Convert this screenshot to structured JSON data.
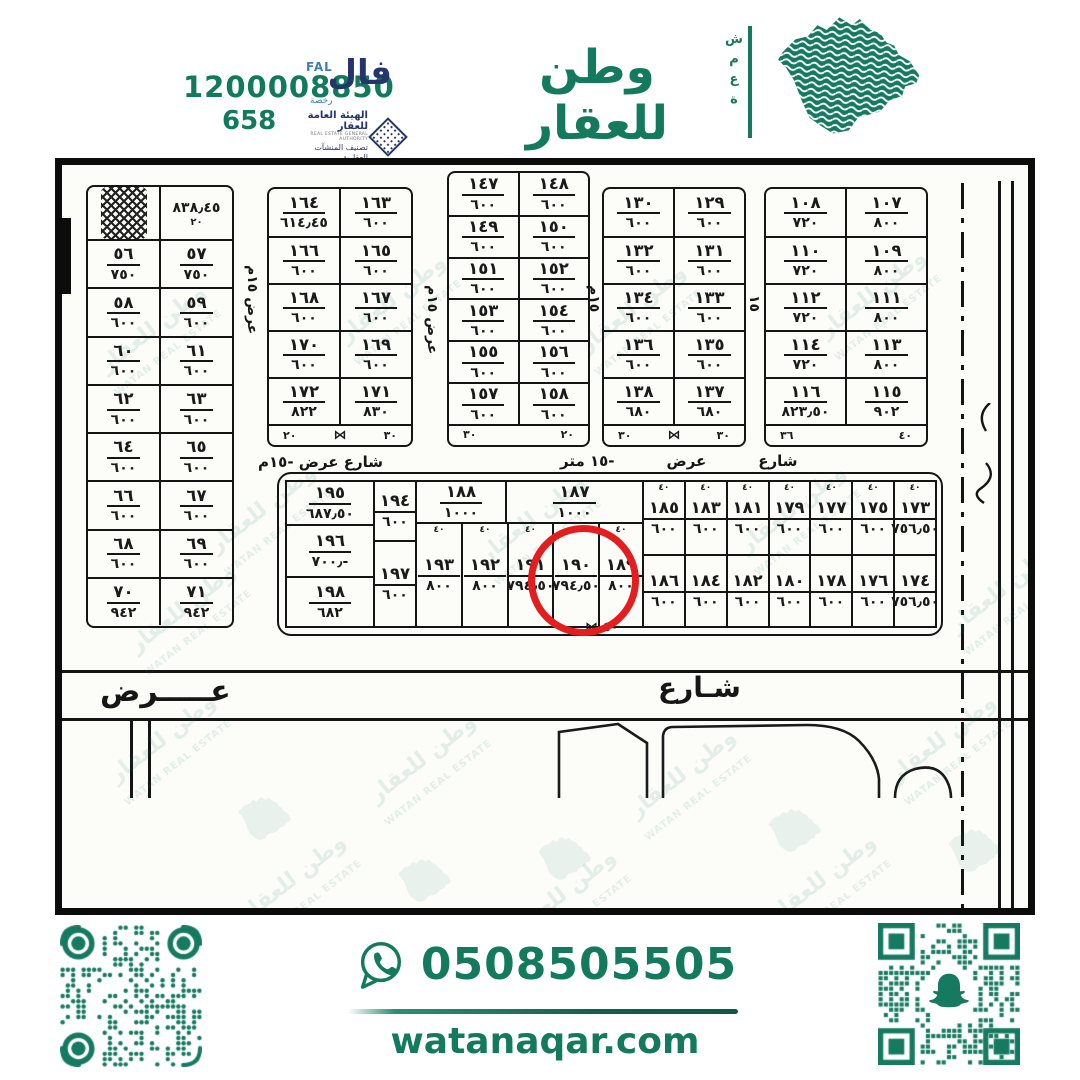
{
  "colors": {
    "brand": "#147a5e",
    "navy": "#25346b",
    "red": "#e41e1e",
    "ink": "#151515"
  },
  "header": {
    "phone_main": "1200008850",
    "phone_small": "658",
    "fal": {
      "arabic": "فال",
      "latin": "FAL",
      "license": "رخصة",
      "authority_ar": "الهيئة العامة للعقار",
      "authority_en": "REAL ESTATE GENERAL AUTHORITY",
      "classification": "تصنيف المنشآت العقارية"
    },
    "brand": {
      "arabic": "وطن للعقار",
      "english": "WATAN REAL ESTATE",
      "vertical_word": "شمعة"
    }
  },
  "map": {
    "watermark": {
      "text_ar": "وطن للعقار",
      "text_en": "WATAN REAL ESTATE"
    },
    "dims": {
      "d20": "٢٠",
      "d26": "٢٦",
      "d30": "٣٠",
      "d36": "٣٦",
      "d40": "٤٠",
      "bow": "⋈"
    },
    "special_cell": {
      "value": "٨٣٨٫٤٥",
      "sub": "٢٠"
    },
    "blocks": {
      "blockA": [
        [
          [
            "٥٦",
            "٧٥٠"
          ],
          [
            "٥٧",
            "٧٥٠"
          ]
        ],
        [
          [
            "٥٨",
            "٦٠٠"
          ],
          [
            "٥٩",
            "٦٠٠"
          ]
        ],
        [
          [
            "٦٠",
            "٦٠٠"
          ],
          [
            "٦١",
            "٦٠٠"
          ]
        ],
        [
          [
            "٦٢",
            "٦٠٠"
          ],
          [
            "٦٣",
            "٦٠٠"
          ]
        ],
        [
          [
            "٦٤",
            "٦٠٠"
          ],
          [
            "٦٥",
            "٦٠٠"
          ]
        ],
        [
          [
            "٦٦",
            "٦٠٠"
          ],
          [
            "٦٧",
            "٦٠٠"
          ]
        ],
        [
          [
            "٦٨",
            "٦٠٠"
          ],
          [
            "٦٩",
            "٦٠٠"
          ]
        ],
        [
          [
            "٧٠",
            "٩٤٢"
          ],
          [
            "٧١",
            "٩٤٢"
          ]
        ]
      ],
      "blockB": [
        [
          [
            "١٦٤",
            "٦١٤٫٤٥"
          ],
          [
            "١٦٣",
            "٦٠٠"
          ]
        ],
        [
          [
            "١٦٦",
            "٦٠٠"
          ],
          [
            "١٦٥",
            "٦٠٠"
          ]
        ],
        [
          [
            "١٦٨",
            "٦٠٠"
          ],
          [
            "١٦٧",
            "٦٠٠"
          ]
        ],
        [
          [
            "١٧٠",
            "٦٠٠"
          ],
          [
            "١٦٩",
            "٦٠٠"
          ]
        ],
        [
          [
            "١٧٢",
            "٨٢٢"
          ],
          [
            "١٧١",
            "٨٣٠"
          ]
        ]
      ],
      "blockC": [
        [
          [
            "١٤٧",
            "٦٠٠"
          ],
          [
            "١٤٨",
            "٦٠٠"
          ]
        ],
        [
          [
            "١٤٩",
            "٦٠٠"
          ],
          [
            "١٥٠",
            "٦٠٠"
          ]
        ],
        [
          [
            "١٥١",
            "٦٠٠"
          ],
          [
            "١٥٢",
            "٦٠٠"
          ]
        ],
        [
          [
            "١٥٣",
            "٦٠٠"
          ],
          [
            "١٥٤",
            "٦٠٠"
          ]
        ],
        [
          [
            "١٥٥",
            "٦٠٠"
          ],
          [
            "١٥٦",
            "٦٠٠"
          ]
        ],
        [
          [
            "١٥٧",
            "٦٠٠"
          ],
          [
            "١٥٨",
            "٦٠٠"
          ]
        ]
      ],
      "blockD": [
        [
          [
            "١٣٠",
            "٦٠٠"
          ],
          [
            "١٢٩",
            "٦٠٠"
          ]
        ],
        [
          [
            "١٣٢",
            "٦٠٠"
          ],
          [
            "١٣١",
            "٦٠٠"
          ]
        ],
        [
          [
            "١٣٤",
            "٦٠٠"
          ],
          [
            "١٣٣",
            "٦٠٠"
          ]
        ],
        [
          [
            "١٣٦",
            "٦٠٠"
          ],
          [
            "١٣٥",
            "٦٠٠"
          ]
        ],
        [
          [
            "١٣٨",
            "٦٨٠"
          ],
          [
            "١٣٧",
            "٦٨٠"
          ]
        ]
      ],
      "blockE": [
        [
          [
            "١٠٨",
            "٧٢٠"
          ],
          [
            "١٠٧",
            "٨٠٠"
          ]
        ],
        [
          [
            "١١٠",
            "٧٢٠"
          ],
          [
            "١٠٩",
            "٨٠٠"
          ]
        ],
        [
          [
            "١١٢",
            "٧٢٠"
          ],
          [
            "١١١",
            "٨٠٠"
          ]
        ],
        [
          [
            "١١٤",
            "٧٢٠"
          ],
          [
            "١١٣",
            "٨٠٠"
          ]
        ],
        [
          [
            "١١٦",
            "٨٢٣٫٥٠"
          ],
          [
            "١١٥",
            "٩٠٢"
          ]
        ]
      ]
    },
    "bottom_block": {
      "colA": [
        [
          "١٩٥",
          "٦٨٧٫٥٠"
        ],
        [
          "١٩٦",
          "٧٠٠٫-"
        ],
        [
          "١٩٨",
          "٦٨٢"
        ]
      ],
      "colB": [
        [
          "١٩٤",
          "٦٠٠"
        ],
        [
          "١٩٧",
          "٦٠٠"
        ]
      ],
      "wide": [
        [
          "١٨٨",
          "١٠٠٠"
        ],
        [
          "١٨٧",
          "١٠٠٠"
        ]
      ],
      "tall": [
        [
          "١٩٣",
          "٨٠٠"
        ],
        [
          "١٩٢",
          "٨٠٠"
        ],
        [
          "١٩١",
          "٧٩٤٫٥٠"
        ],
        [
          "١٩٠",
          "٧٩٤٫٥٠"
        ],
        [
          "١٨٩",
          "٨٠٠"
        ]
      ],
      "grid_top": [
        [
          "١٨٥",
          "٦٠٠"
        ],
        [
          "١٨٣",
          "٦٠٠"
        ],
        [
          "١٨١",
          "٦٠٠"
        ],
        [
          "١٧٩",
          "٦٠٠"
        ],
        [
          "١٧٧",
          "٦٠٠"
        ],
        [
          "١٧٥",
          "٦٠٠"
        ],
        [
          "١٧٣",
          "٧٥٦٫٥٠"
        ]
      ],
      "grid_bottom": [
        [
          "١٨٦",
          "٦٠٠"
        ],
        [
          "١٨٤",
          "٦٠٠"
        ],
        [
          "١٨٢",
          "٦٠٠"
        ],
        [
          "١٨٠",
          "٦٠٠"
        ],
        [
          "١٧٨",
          "٦٠٠"
        ],
        [
          "١٧٦",
          "٦٠٠"
        ],
        [
          "١٧٤",
          "٧٥٦٫٥٠"
        ]
      ]
    },
    "highlighted_plot": "١٩٠",
    "streets": {
      "under_blockB": "شارع عرض -١٥م",
      "mid_parts": [
        "شارع",
        "عرض",
        "-١٥ متر"
      ],
      "bottom_left": "عـــــرض",
      "bottom_right": "شـارع",
      "v1": "عرض ١٥م",
      "v2": "عرض ١٥م",
      "v3": "١٥م",
      "v4": "١٥"
    }
  },
  "footer": {
    "whatsapp_number": "0508505505",
    "website": "watanaqar.com"
  }
}
